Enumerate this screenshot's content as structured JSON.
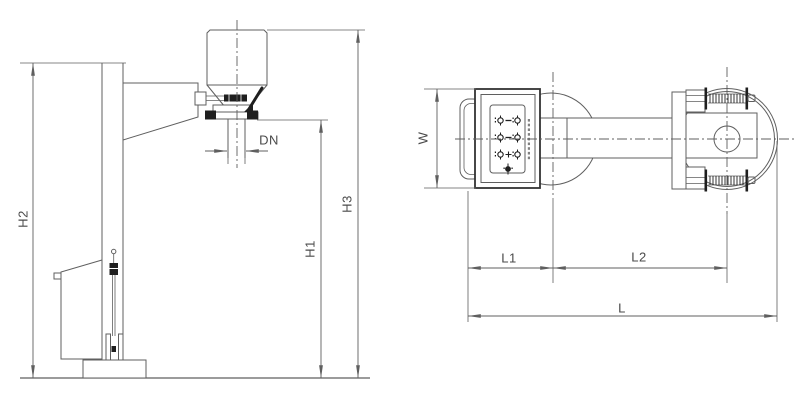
{
  "drawing": {
    "labels": {
      "h2": "H2",
      "h1": "H1",
      "h3": "H3",
      "dn": "DN",
      "w": "W",
      "l1": "L1",
      "l2": "L2",
      "l": "L"
    },
    "icons": {
      "panel_buttons": [
        "indicator-pair-icon",
        "indicator-pair-icon",
        "indicator-pair-plus-icon",
        "single-button-icon"
      ]
    }
  },
  "colors": {
    "line": "#5f5f5f",
    "dark": "#1f1f1f",
    "text": "#4a4a4a",
    "panel_border": "#333333",
    "background": "#ffffff",
    "glyph": "#808080"
  }
}
